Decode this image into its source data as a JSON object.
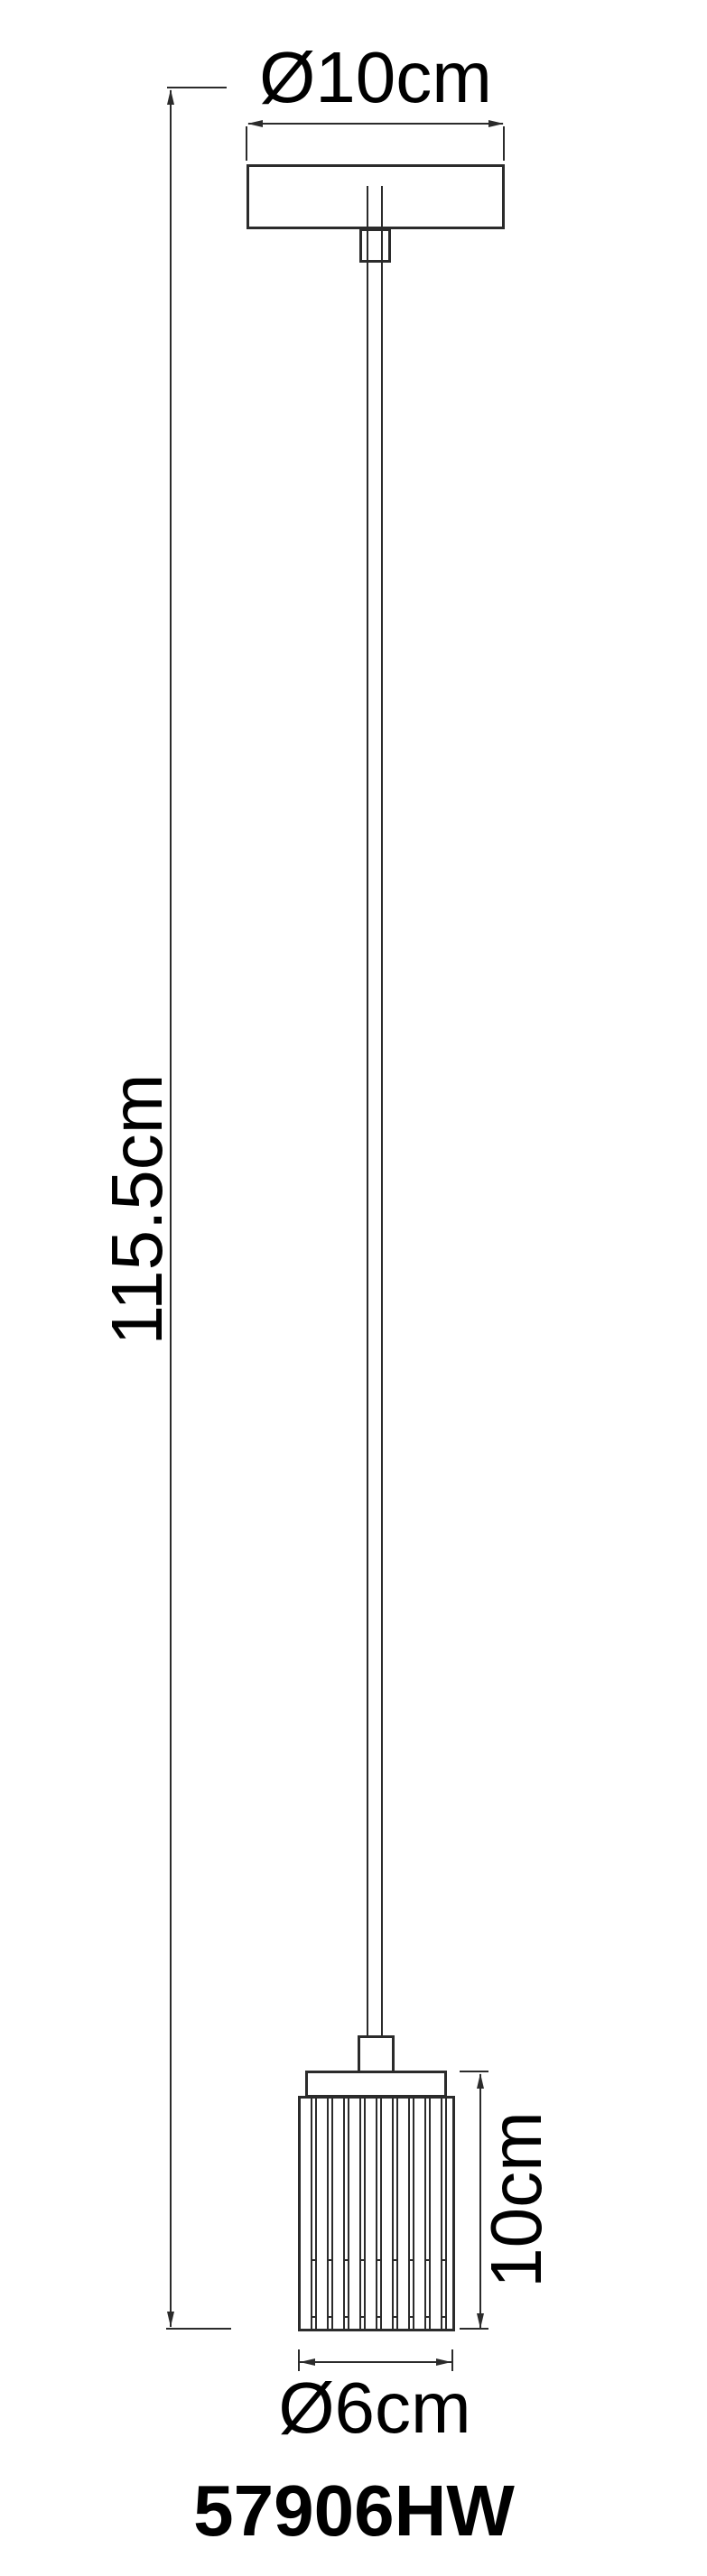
{
  "diagram": {
    "type": "technical-dimension-drawing",
    "product": "pendant lamp line drawing",
    "model": "57906HW",
    "dimensions": {
      "canopy_diameter": "Ø10cm",
      "overall_height": "115.5cm",
      "shade_height": "10cm",
      "shade_diameter": "Ø6cm"
    },
    "colors": {
      "line": "#2b2b2b",
      "text": "#000000",
      "background": "#ffffff"
    }
  }
}
